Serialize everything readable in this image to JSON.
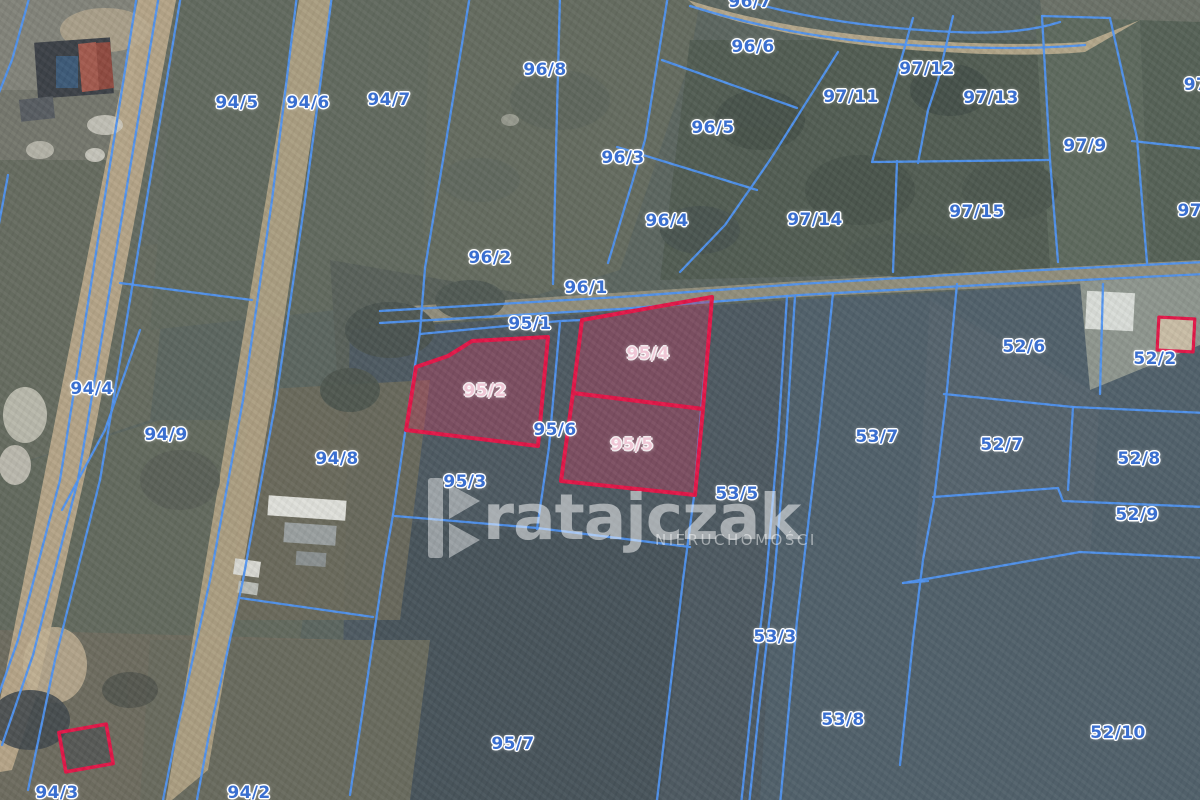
{
  "map": {
    "watermark": {
      "brand": "ratajczak",
      "subtitle": "NIERUCHOMOŚCI"
    },
    "colors": {
      "parcel_line_blue": "#4f93f2",
      "highlight_stroke": "#e31748",
      "highlight_fill": "rgba(189,62,95,0.42)",
      "label_blue": "#3a6fd0",
      "label_pink": "#efc6d5"
    },
    "highlighted_parcels": [
      "95/2",
      "95/4",
      "95/5"
    ],
    "labels": [
      {
        "text": "94/5",
        "x": 237,
        "y": 103
      },
      {
        "text": "94/6",
        "x": 308,
        "y": 103
      },
      {
        "text": "94/7",
        "x": 389,
        "y": 100
      },
      {
        "text": "96/8",
        "x": 545,
        "y": 70
      },
      {
        "text": "96/7",
        "x": 750,
        "y": 2
      },
      {
        "text": "96/6",
        "x": 753,
        "y": 47
      },
      {
        "text": "97/12",
        "x": 927,
        "y": 69
      },
      {
        "text": "97/11",
        "x": 851,
        "y": 97
      },
      {
        "text": "97/13",
        "x": 991,
        "y": 98
      },
      {
        "text": "97",
        "x": 1196,
        "y": 85
      },
      {
        "text": "97/9",
        "x": 1085,
        "y": 146
      },
      {
        "text": "96/5",
        "x": 713,
        "y": 128
      },
      {
        "text": "96/3",
        "x": 623,
        "y": 158
      },
      {
        "text": "97/14",
        "x": 815,
        "y": 220
      },
      {
        "text": "97/15",
        "x": 977,
        "y": 212
      },
      {
        "text": "97/",
        "x": 1193,
        "y": 211
      },
      {
        "text": "96/4",
        "x": 667,
        "y": 221
      },
      {
        "text": "96/2",
        "x": 490,
        "y": 258
      },
      {
        "text": "96/1",
        "x": 586,
        "y": 288
      },
      {
        "text": "95/1",
        "x": 530,
        "y": 324
      },
      {
        "text": "94/4",
        "x": 92,
        "y": 389
      },
      {
        "text": "94/9",
        "x": 166,
        "y": 435
      },
      {
        "text": "94/8",
        "x": 337,
        "y": 459
      },
      {
        "text": "95/2",
        "x": 485,
        "y": 391,
        "variant": "pink"
      },
      {
        "text": "95/4",
        "x": 648,
        "y": 354,
        "variant": "pink"
      },
      {
        "text": "95/6",
        "x": 555,
        "y": 430
      },
      {
        "text": "95/5",
        "x": 632,
        "y": 445,
        "variant": "pink"
      },
      {
        "text": "95/3",
        "x": 465,
        "y": 482
      },
      {
        "text": "53/5",
        "x": 737,
        "y": 494
      },
      {
        "text": "52/6",
        "x": 1024,
        "y": 347
      },
      {
        "text": "52/2",
        "x": 1155,
        "y": 359
      },
      {
        "text": "53/7",
        "x": 877,
        "y": 437
      },
      {
        "text": "52/7",
        "x": 1002,
        "y": 445
      },
      {
        "text": "52/8",
        "x": 1139,
        "y": 459
      },
      {
        "text": "52/9",
        "x": 1137,
        "y": 515
      },
      {
        "text": "53/3",
        "x": 775,
        "y": 637
      },
      {
        "text": "53/8",
        "x": 843,
        "y": 720
      },
      {
        "text": "52/10",
        "x": 1118,
        "y": 733
      },
      {
        "text": "95/7",
        "x": 513,
        "y": 744
      },
      {
        "text": "94/3",
        "x": 57,
        "y": 793
      },
      {
        "text": "94/2",
        "x": 249,
        "y": 793
      }
    ]
  }
}
